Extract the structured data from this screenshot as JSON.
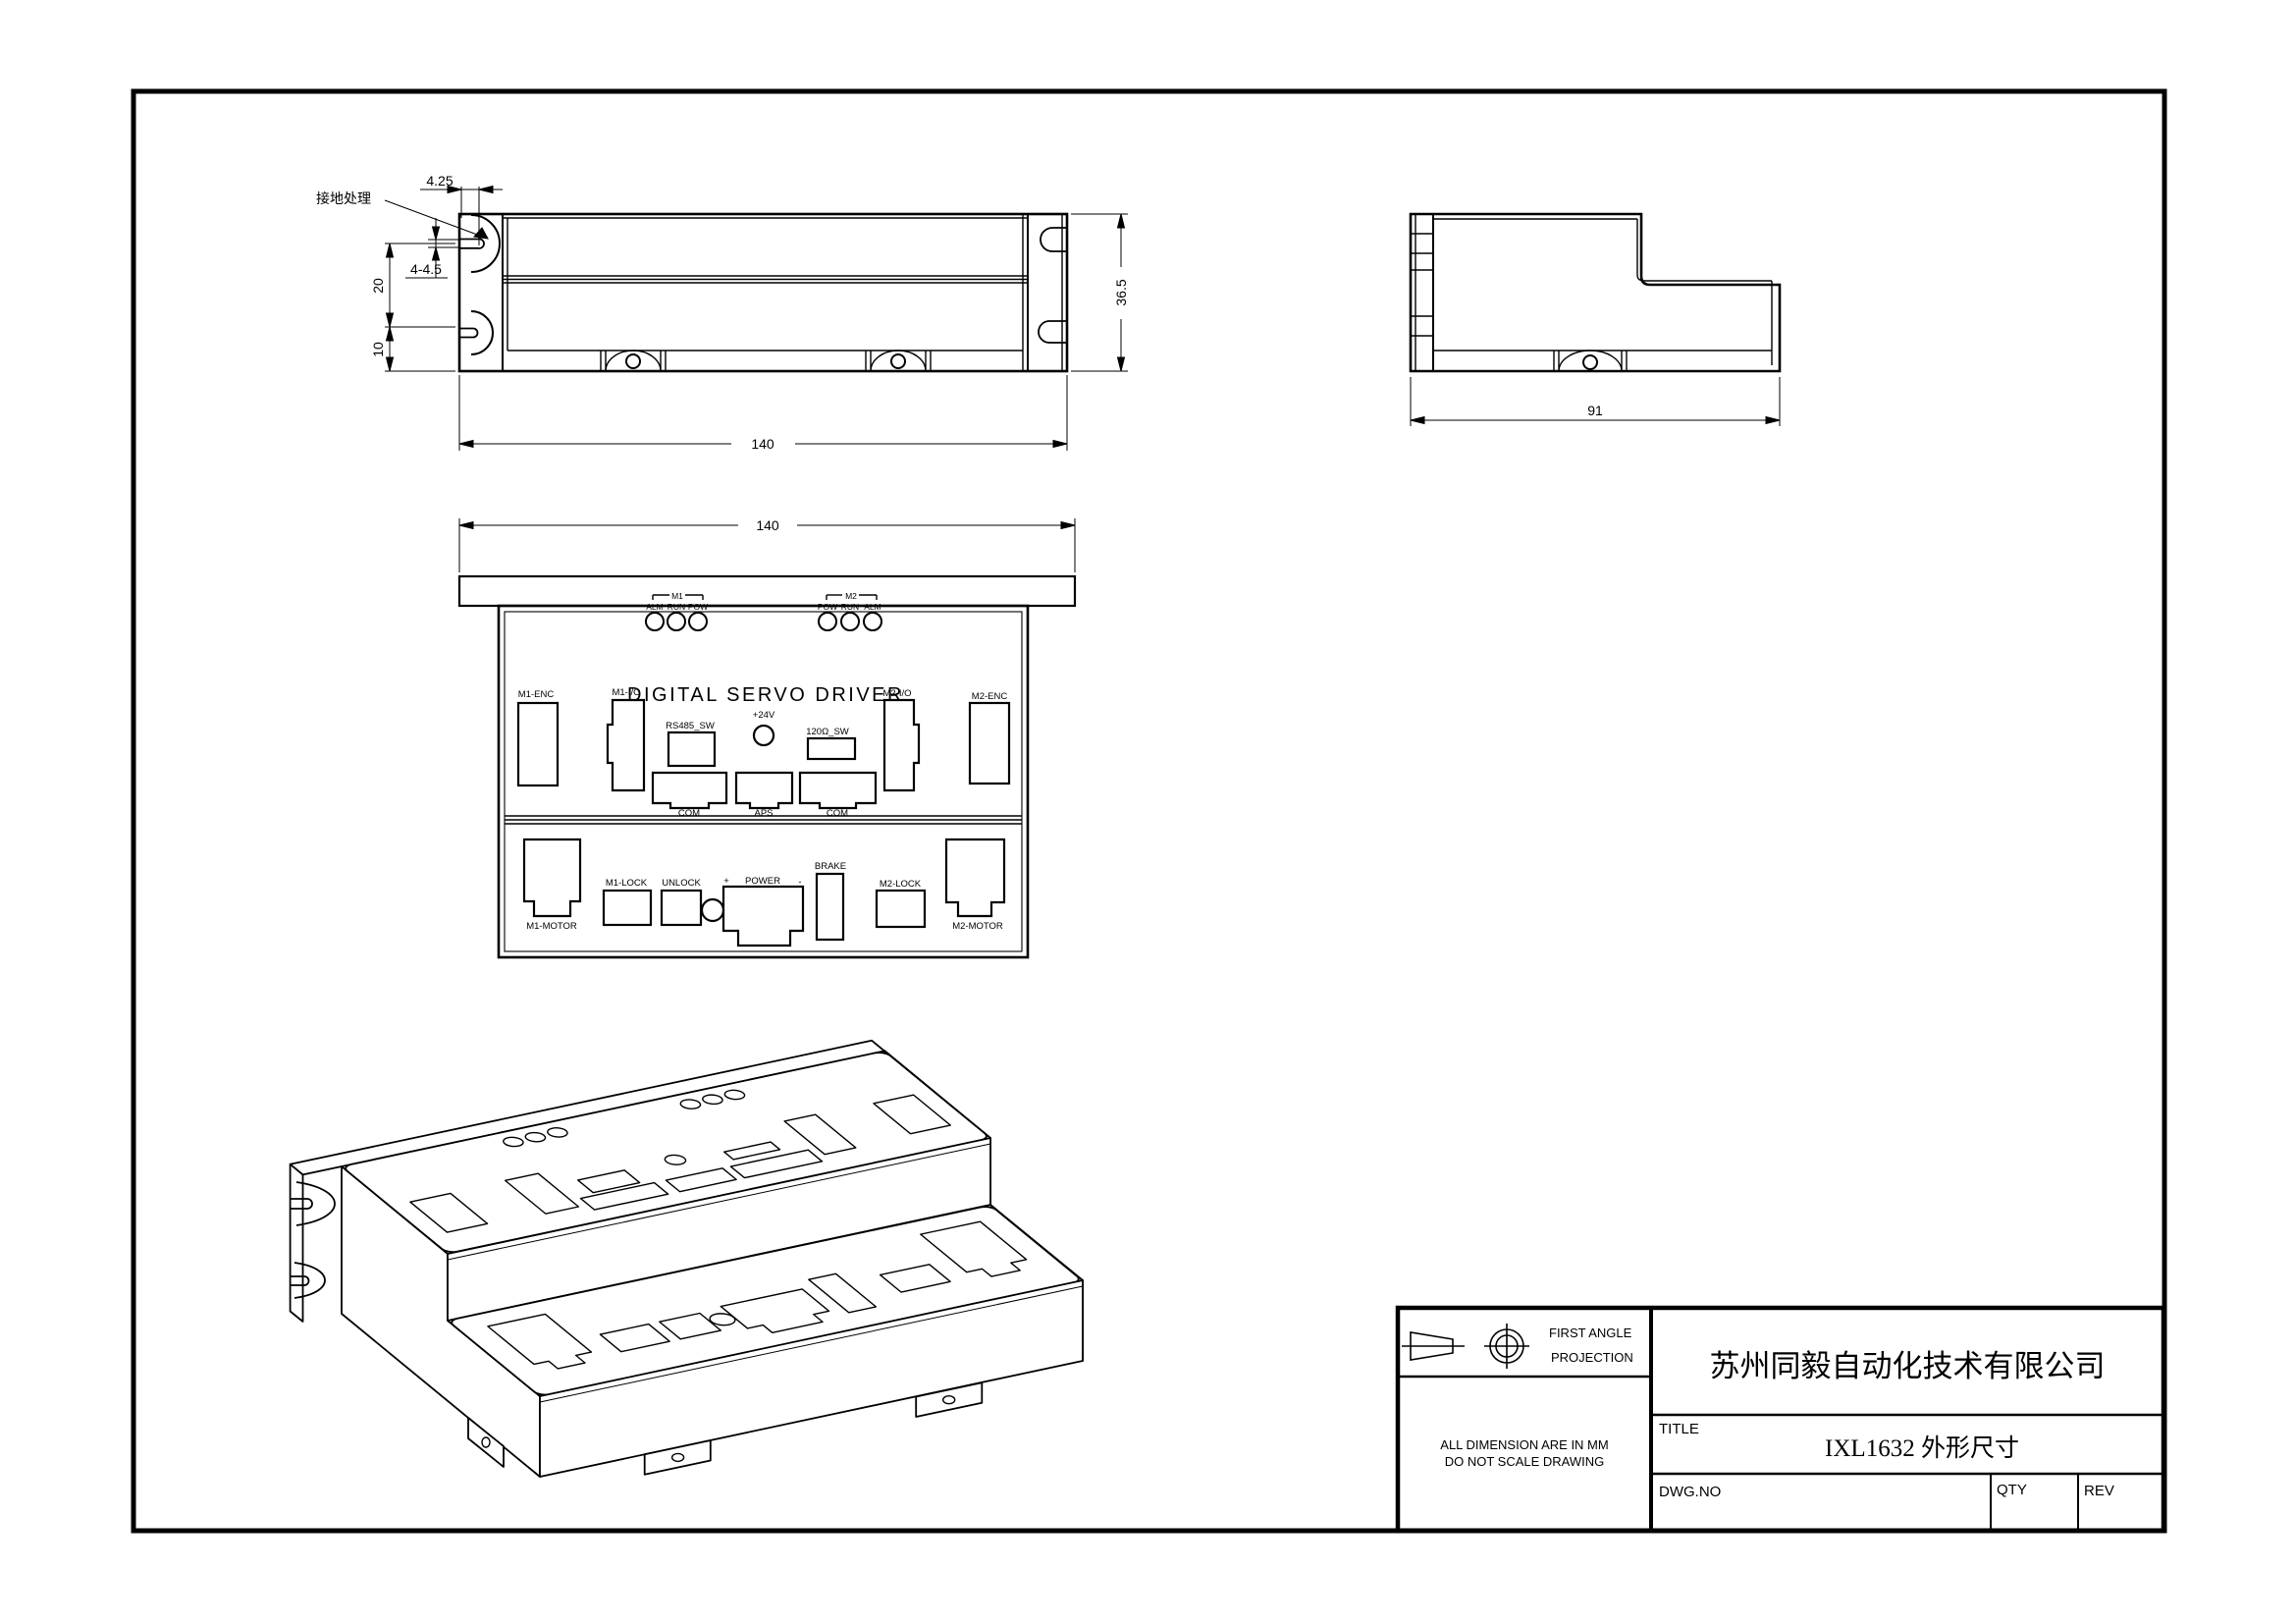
{
  "front_view": {
    "ground_label": "接地处理",
    "dim_offset": "4.25",
    "dim_slot": "4-4.5",
    "dim_pitch": "20",
    "dim_edge": "10",
    "dim_width": "140",
    "dim_height": "36.5"
  },
  "side_view": {
    "dim_depth": "91"
  },
  "panel": {
    "dim_width": "140",
    "title": "DIGITAL SERVO DRIVER",
    "m1_group_label": "M1",
    "m2_group_label": "M2",
    "m1_leds": [
      "ALM",
      "RUN",
      "POW"
    ],
    "m2_leds": [
      "POW",
      "RUN",
      "ALM"
    ],
    "m1_enc": "M1-ENC",
    "m1_io": "M1-I/O",
    "rs485": "RS485_SW",
    "plus24v": "+24V",
    "term_sw": "120Ω_SW",
    "m2_io": "M2-I/O",
    "m2_enc": "M2-ENC",
    "com_left": "COM",
    "aps": "APS",
    "com_right": "COM",
    "m1_motor": "M1-MOTOR",
    "m1_lock": "M1-LOCK",
    "unlock": "UNLOCK",
    "power_plus": "+",
    "power": "POWER",
    "power_minus": "-",
    "brake": "BRAKE",
    "m2_lock": "M2-LOCK",
    "m2_motor": "M2-MOTOR"
  },
  "title_block": {
    "projection_line1": "FIRST ANGLE",
    "projection_line2": "PROJECTION",
    "note_line1": "ALL DIMENSION ARE IN MM",
    "note_line2": "DO NOT SCALE DRAWING",
    "company": "苏州同毅自动化技术有限公司",
    "title_label": "TITLE",
    "title": "IXL1632 外形尺寸",
    "dwg_label": "DWG.NO",
    "qty_label": "QTY",
    "rev_label": "REV"
  }
}
